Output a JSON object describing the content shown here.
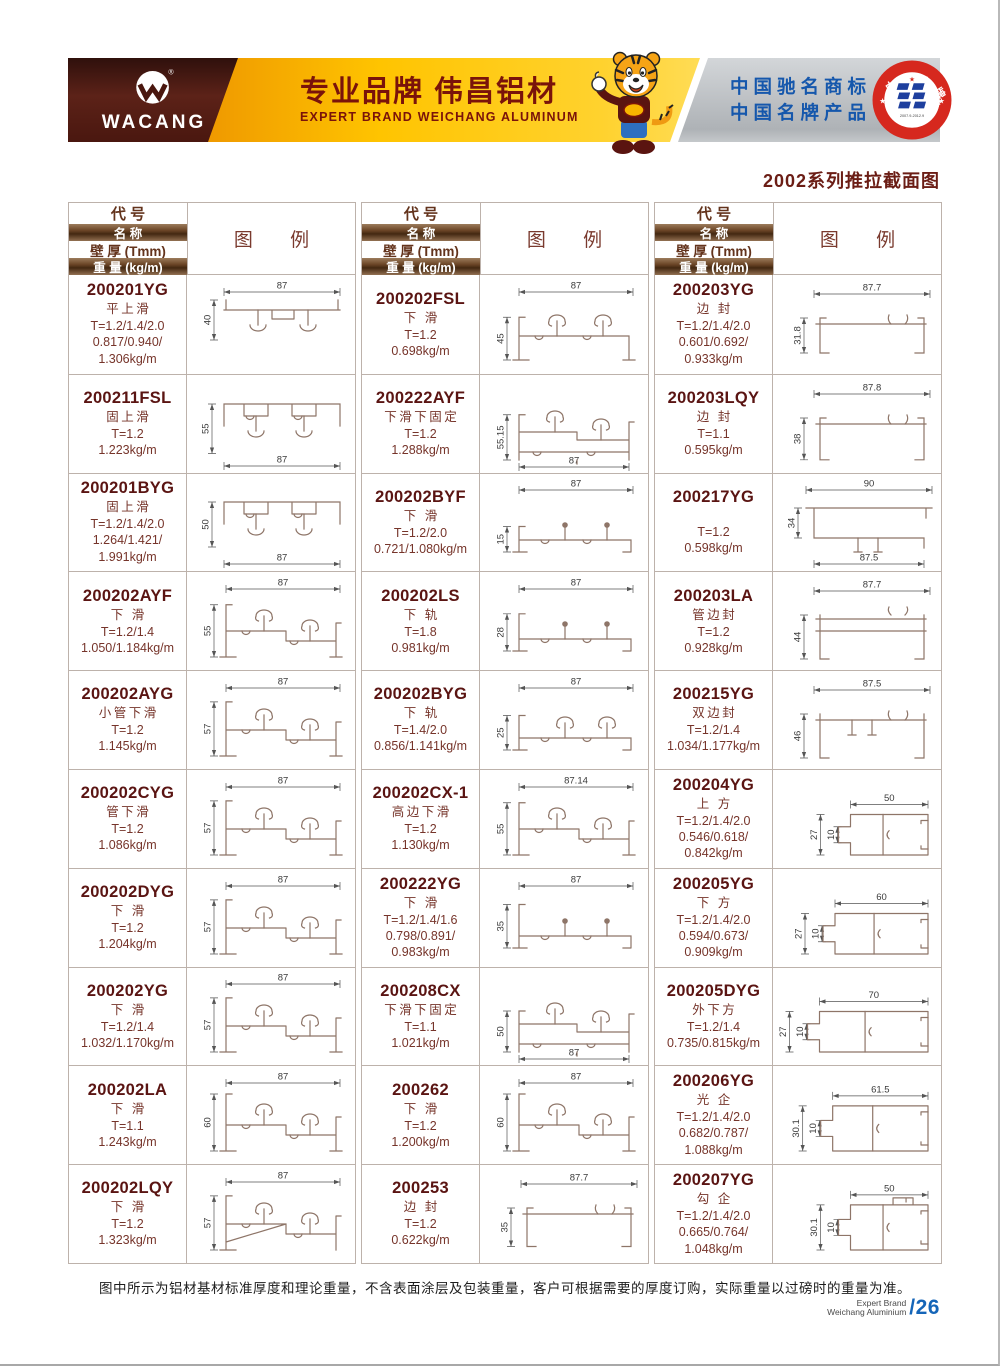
{
  "banner": {
    "logo_text": "WACANG",
    "registered_mark": "®",
    "slogan_cn": "专业品牌  伟昌铝材",
    "slogan_en": "EXPERT BRAND WEICHANG ALUMINUM",
    "honor_line1": "中国驰名商标",
    "honor_line2": "中国名牌产品",
    "badge_top": "中国名牌",
    "badge_bottom": "CHINA TOP BRAND",
    "badge_dates": "2007.9-2012.9",
    "colors": {
      "maroon": "#4a1a12",
      "gold": "#ffc400",
      "blue": "#1557ac",
      "badge_red": "#d6281e"
    }
  },
  "page": {
    "series_title": "2002系列推拉截面图",
    "footer_note": "图中所示为铝材基材标准厚度和理论重量，不含表面涂层及包装重量，客户可根据需要的厚度订购，实际重量以过磅时的重量为准。",
    "brand_line1": "Expert Brand",
    "brand_line2": "Weichang Aluminium",
    "page_number": "/26"
  },
  "table_headers": {
    "code": "代  号",
    "name": "名  称",
    "thickness": "壁 厚 (Tmm)",
    "weight": "重 量 (kg/m)",
    "diagram": "图  例"
  },
  "tables": [
    {
      "rows": [
        {
          "code": "200201YG",
          "name": "平上滑",
          "t": "T=1.2/1.4/2.0",
          "wt": [
            "0.817/0.940/",
            "1.306kg/m"
          ],
          "shape": "topSlideA",
          "dims": {
            "top": "87",
            "left": "40"
          }
        },
        {
          "code": "200211FSL",
          "name": "固上滑",
          "t": "T=1.2",
          "wt": [
            "1.223kg/m"
          ],
          "shape": "topSlideB",
          "dims": {
            "left": "55",
            "bottom": "87"
          }
        },
        {
          "code": "200201BYG",
          "name": "固上滑",
          "t": "T=1.2/1.4/2.0",
          "wt": [
            "1.264/1.421/",
            "1.991kg/m"
          ],
          "shape": "topSlideB",
          "dims": {
            "left": "50",
            "bottom": "87"
          }
        },
        {
          "code": "200202AYF",
          "name": "下 滑",
          "t": "T=1.2/1.4",
          "wt": [
            "1.050/1.184kg/m"
          ],
          "shape": "bottomSlide",
          "dims": {
            "top": "87",
            "left": "55"
          }
        },
        {
          "code": "200202AYG",
          "name": "小管下滑",
          "t": "T=1.2",
          "wt": [
            "1.145kg/m"
          ],
          "shape": "bottomSlide",
          "dims": {
            "top": "87",
            "left": "57"
          }
        },
        {
          "code": "200202CYG",
          "name": "管下滑",
          "t": "T=1.2",
          "wt": [
            "1.086kg/m"
          ],
          "shape": "bottomSlide",
          "dims": {
            "top": "87",
            "left": "57"
          }
        },
        {
          "code": "200202DYG",
          "name": "下 滑",
          "t": "T=1.2",
          "wt": [
            "1.204kg/m"
          ],
          "shape": "bottomSlide",
          "dims": {
            "top": "87",
            "left": "57"
          }
        },
        {
          "code": "200202YG",
          "name": "下 滑",
          "t": "T=1.2/1.4",
          "wt": [
            "1.032/1.170kg/m"
          ],
          "shape": "bottomSlide",
          "dims": {
            "top": "87",
            "left": "57"
          }
        },
        {
          "code": "200202LA",
          "name": "下 滑",
          "t": "T=1.1",
          "wt": [
            "1.243kg/m"
          ],
          "shape": "bottomSlide",
          "dims": {
            "top": "87",
            "left": "60"
          }
        },
        {
          "code": "200202LQY",
          "name": "下 滑",
          "t": "T=1.2",
          "wt": [
            "1.323kg/m"
          ],
          "shape": "bottomSlideSlant",
          "dims": {
            "top": "87",
            "left": "57"
          }
        }
      ]
    },
    {
      "rows": [
        {
          "code": "200202FSL",
          "name": "下 滑",
          "t": "T=1.2",
          "wt": [
            "0.698kg/m"
          ],
          "shape": "bottomSlideFlat",
          "dims": {
            "top": "87",
            "left": "45"
          }
        },
        {
          "code": "200222AYF",
          "name": "下滑下固定",
          "t": "T=1.2",
          "wt": [
            "1.288kg/m"
          ],
          "shape": "bottomSlideB",
          "dims": {
            "left": "55.15",
            "bottom": "87"
          }
        },
        {
          "code": "200202BYF",
          "name": "下 滑",
          "t": "T=1.2/2.0",
          "wt": [
            "0.721/1.080kg/m"
          ],
          "shape": "railBall",
          "dims": {
            "top": "87",
            "left": "15"
          }
        },
        {
          "code": "200202LS",
          "name": "下 轨",
          "t": "T=1.8",
          "wt": [
            "0.981kg/m"
          ],
          "shape": "railBall",
          "dims": {
            "top": "87",
            "left": "28"
          }
        },
        {
          "code": "200202BYG",
          "name": "下 轨",
          "t": "T=1.4/2.0",
          "wt": [
            "0.856/1.141kg/m"
          ],
          "shape": "rail",
          "dims": {
            "top": "87",
            "left": "25"
          }
        },
        {
          "code": "200202CX-1",
          "name": "高边下滑",
          "t": "T=1.2",
          "wt": [
            "1.130kg/m"
          ],
          "shape": "bottomSlide",
          "dims": {
            "top": "87.14",
            "left": "55"
          }
        },
        {
          "code": "200222YG",
          "name": "下 滑",
          "t": "T=1.2/1.4/1.6",
          "wt": [
            "0.798/0.891/",
            "0.983kg/m"
          ],
          "shape": "railBall",
          "dims": {
            "top": "87",
            "left": "35"
          }
        },
        {
          "code": "200208CX",
          "name": "下滑下固定",
          "t": "T=1.1",
          "wt": [
            "1.021kg/m"
          ],
          "shape": "bottomSlideB",
          "dims": {
            "left": "50",
            "bottom": "87"
          }
        },
        {
          "code": "200262",
          "name": "下 滑",
          "t": "T=1.2",
          "wt": [
            "1.200kg/m"
          ],
          "shape": "bottomSlide",
          "dims": {
            "top": "87",
            "left": "60"
          }
        },
        {
          "code": "200253",
          "name": "边 封",
          "t": "T=1.2",
          "wt": [
            "0.622kg/m"
          ],
          "shape": "edgeSeal",
          "dims": {
            "top": "87.7",
            "left": "35"
          }
        }
      ]
    },
    {
      "rows": [
        {
          "code": "200203YG",
          "name": "边 封",
          "t": "T=1.2/1.4/2.0",
          "wt": [
            "0.601/0.692/",
            "0.933kg/m"
          ],
          "shape": "edgeSeal",
          "dims": {
            "top": "87.7",
            "left": "31.8"
          }
        },
        {
          "code": "200203LQY",
          "name": "边 封",
          "t": "T=1.1",
          "wt": [
            "0.595kg/m"
          ],
          "shape": "edgeSeal",
          "dims": {
            "top": "87.8",
            "left": "38"
          }
        },
        {
          "code": "200217YG",
          "name": "",
          "t": "T=1.2",
          "wt": [
            "0.598kg/m"
          ],
          "shape": "edgeSealB",
          "dims": {
            "top": "90",
            "left": "34",
            "bottom": "87.5"
          }
        },
        {
          "code": "200203LA",
          "name": "管边封",
          "t": "T=1.2",
          "wt": [
            "0.928kg/m"
          ],
          "shape": "edgeSealTube",
          "dims": {
            "top": "87.7",
            "left": "44"
          }
        },
        {
          "code": "200215YG",
          "name": "双边封",
          "t": "T=1.2/1.4",
          "wt": [
            "1.034/1.177kg/m"
          ],
          "shape": "edgeSealDouble",
          "dims": {
            "top": "87.5",
            "left": "46"
          }
        },
        {
          "code": "200204YG",
          "name": "上 方",
          "t": "T=1.2/1.4/2.0",
          "wt": [
            "0.546/0.618/",
            "0.842kg/m"
          ],
          "shape": "box",
          "dims": {
            "top": "50",
            "left": "27",
            "inner": "10"
          }
        },
        {
          "code": "200205YG",
          "name": "下 方",
          "t": "T=1.2/1.4/2.0",
          "wt": [
            "0.594/0.673/",
            "0.909kg/m"
          ],
          "shape": "box",
          "dims": {
            "top": "60",
            "left": "27",
            "inner": "10"
          }
        },
        {
          "code": "200205DYG",
          "name": "外下方",
          "t": "T=1.2/1.4",
          "wt": [
            "0.735/0.815kg/m"
          ],
          "shape": "box",
          "dims": {
            "top": "70",
            "left": "27",
            "inner": "10"
          }
        },
        {
          "code": "200206YG",
          "name": "光 企",
          "t": "T=1.2/1.4/2.0",
          "wt": [
            "0.682/0.787/",
            "1.088kg/m"
          ],
          "shape": "box",
          "dims": {
            "top": "61.5",
            "left": "30.1",
            "inner": "10"
          }
        },
        {
          "code": "200207YG",
          "name": "勾 企",
          "t": "T=1.2/1.4/2.0",
          "wt": [
            "0.665/0.764/",
            "1.048kg/m"
          ],
          "shape": "boxHook",
          "dims": {
            "top": "50",
            "left": "30.1",
            "inner": "10"
          }
        }
      ]
    }
  ]
}
